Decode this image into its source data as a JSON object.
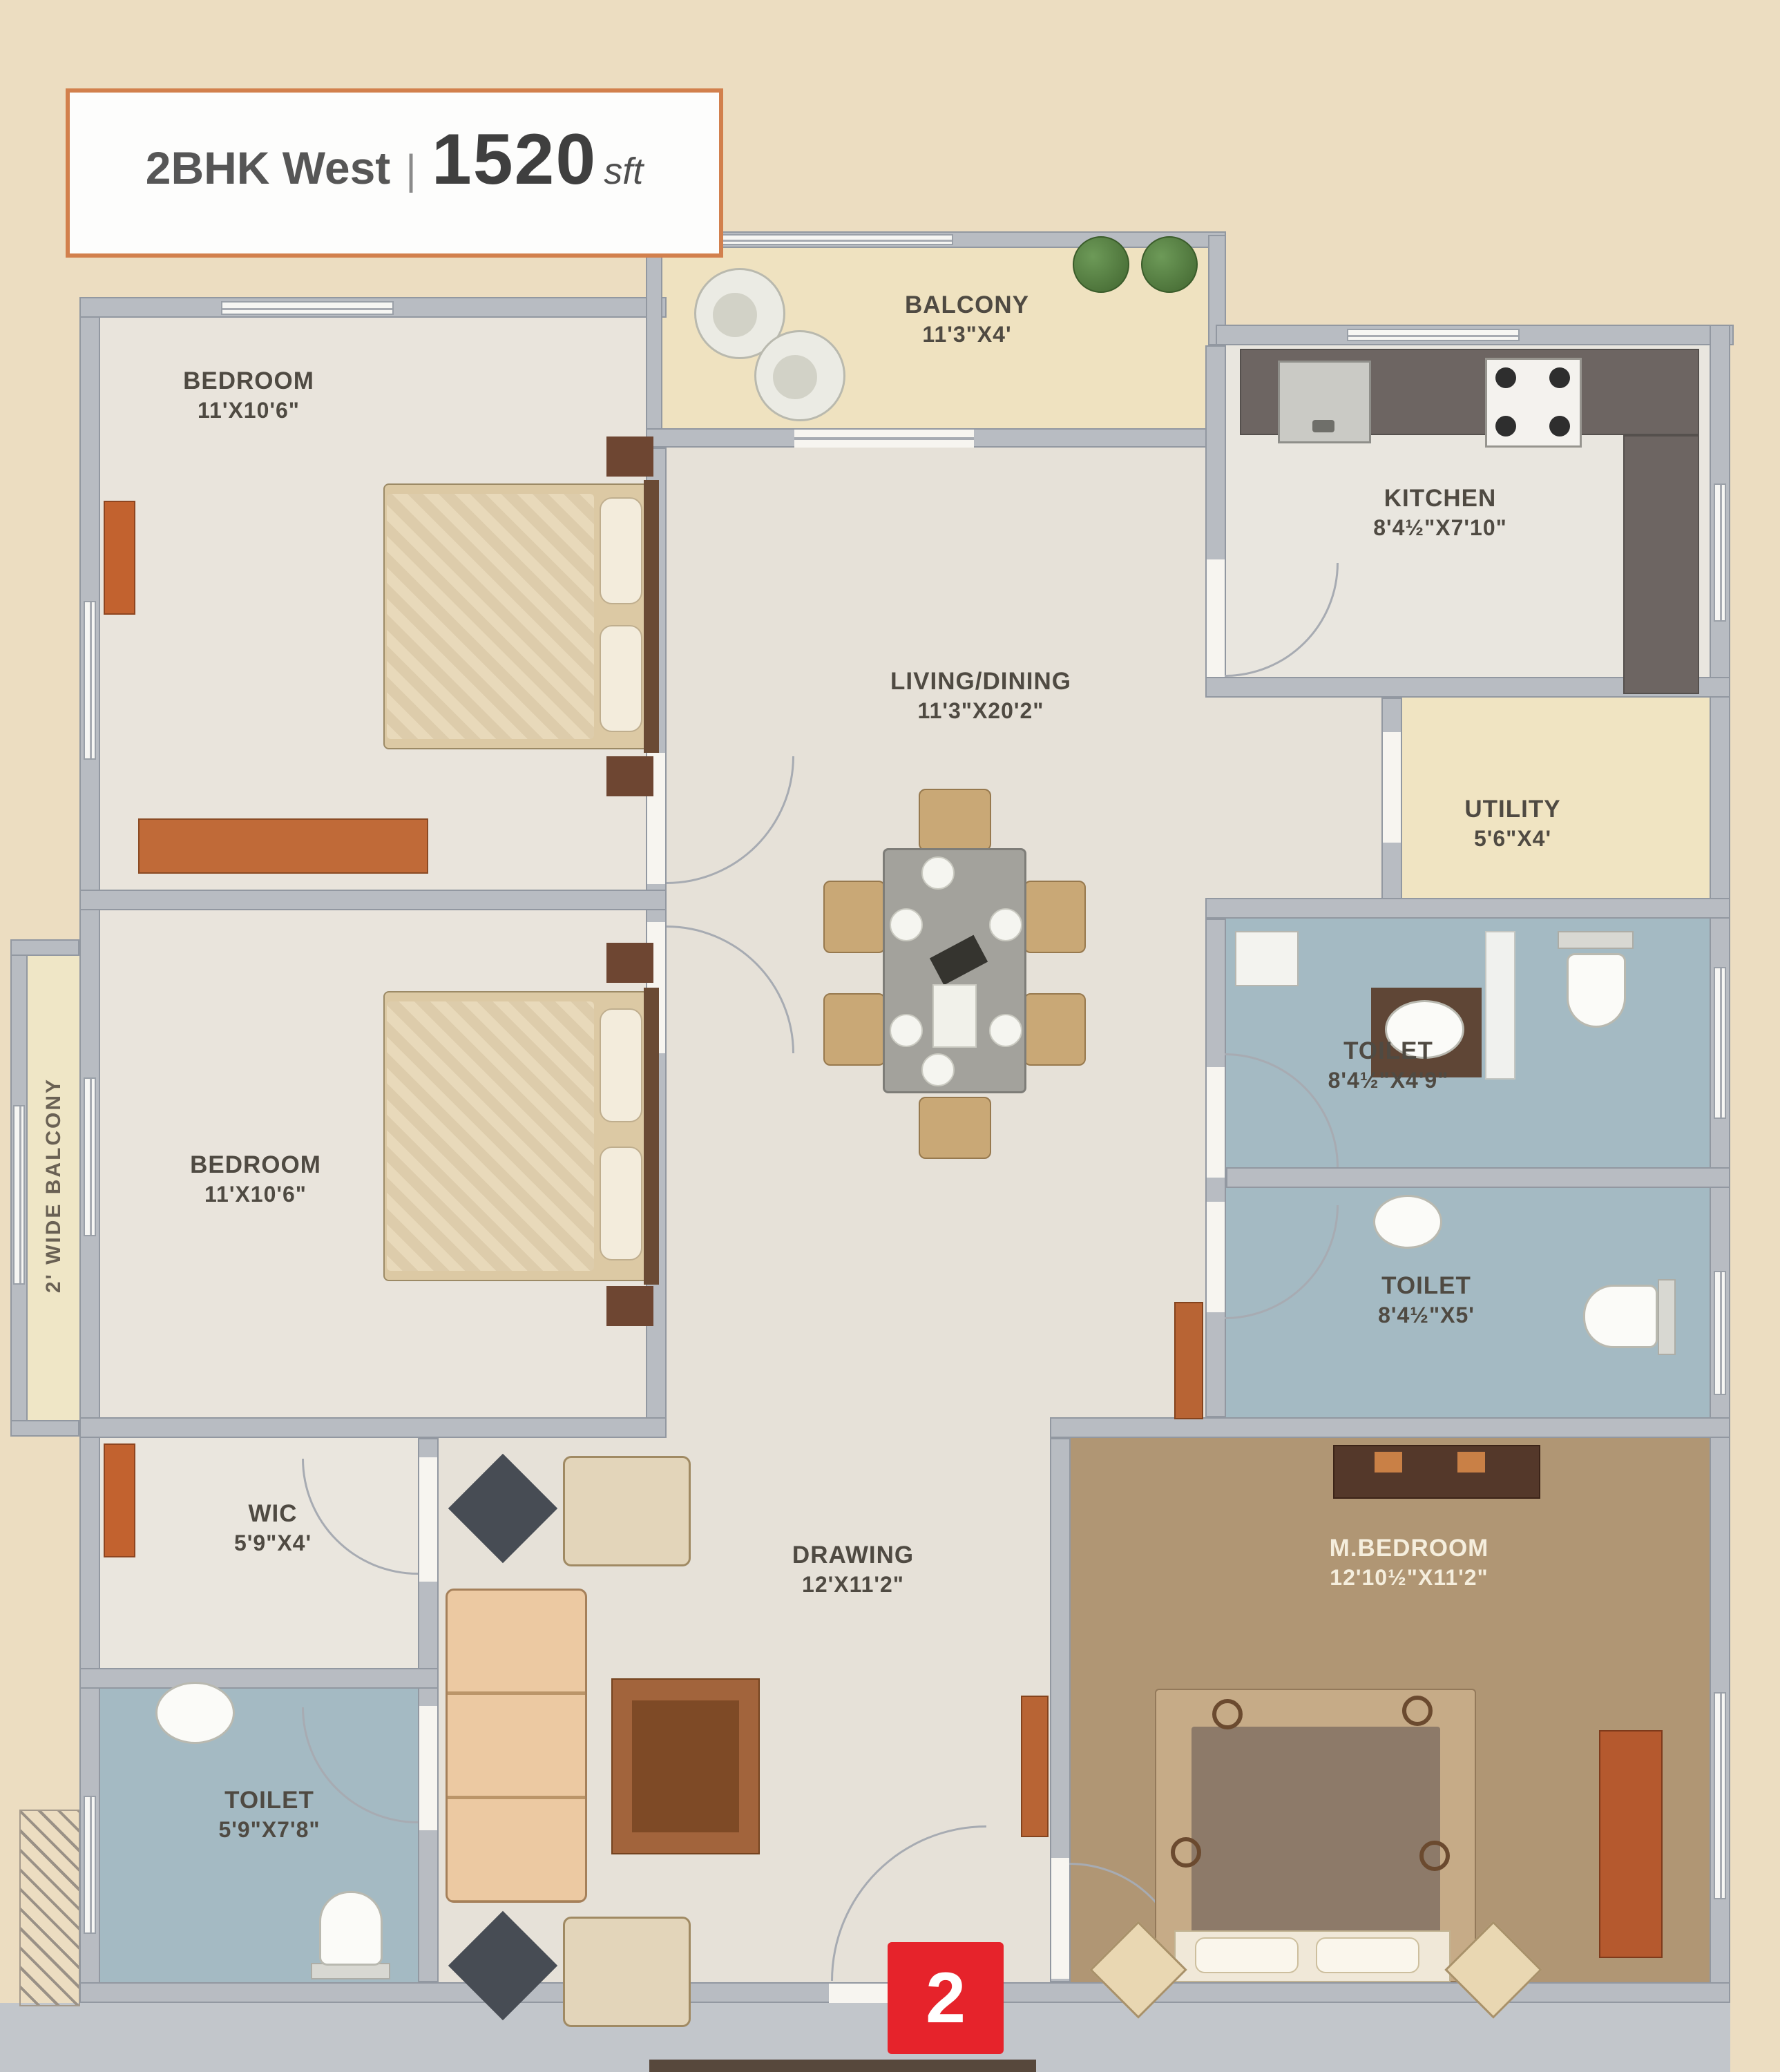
{
  "title": {
    "name": "2BHK West",
    "divider": "|",
    "area": "1520",
    "unit": "sft"
  },
  "rooms": {
    "bedroom1": {
      "label": "BEDROOM",
      "dims": "11'X10'6\""
    },
    "bedroom2": {
      "label": "BEDROOM",
      "dims": "11'X10'6\""
    },
    "balcony": {
      "label": "BALCONY",
      "dims": "11'3\"X4'"
    },
    "kitchen": {
      "label": "KITCHEN",
      "dims": "8'4½\"X7'10\""
    },
    "living_dining": {
      "label": "LIVING/DINING",
      "dims": "11'3\"X20'2\""
    },
    "utility": {
      "label": "UTILITY",
      "dims": "5'6\"X4'"
    },
    "toilet_top": {
      "label": "TOILET",
      "dims": "8'4½\"X4'9\""
    },
    "toilet_mid": {
      "label": "TOILET",
      "dims": "8'4½\"X5'"
    },
    "wic": {
      "label": "WIC",
      "dims": "5'9\"X4'"
    },
    "toilet_bottom": {
      "label": "TOILET",
      "dims": "5'9\"X7'8\""
    },
    "drawing": {
      "label": "DRAWING",
      "dims": "12'X11'2\""
    },
    "master_bedroom": {
      "label": "M.BEDROOM",
      "dims": "12'10½\"X11'2\""
    },
    "side_balcony": {
      "label": "2' WIDE BALCONY"
    }
  },
  "markers": {
    "entry_unit": "2"
  },
  "colors": {
    "page_background": "#ecddc1",
    "wall": "#b8bcc2",
    "bedroom_floor": "#e9e4dc",
    "living_floor": "#e6e1d8",
    "toilet_floor": "#a4bac3",
    "master_floor": "#b09674",
    "balcony_floor": "#efe2c0",
    "utility_floor": "#f0e4c2",
    "corridor": "#c2c6cb",
    "kitchen_counter": "#6d6562",
    "wood_furniture": "#c2622f",
    "title_accent": "#d2804d",
    "entry_marker_red": "#e6232b"
  }
}
